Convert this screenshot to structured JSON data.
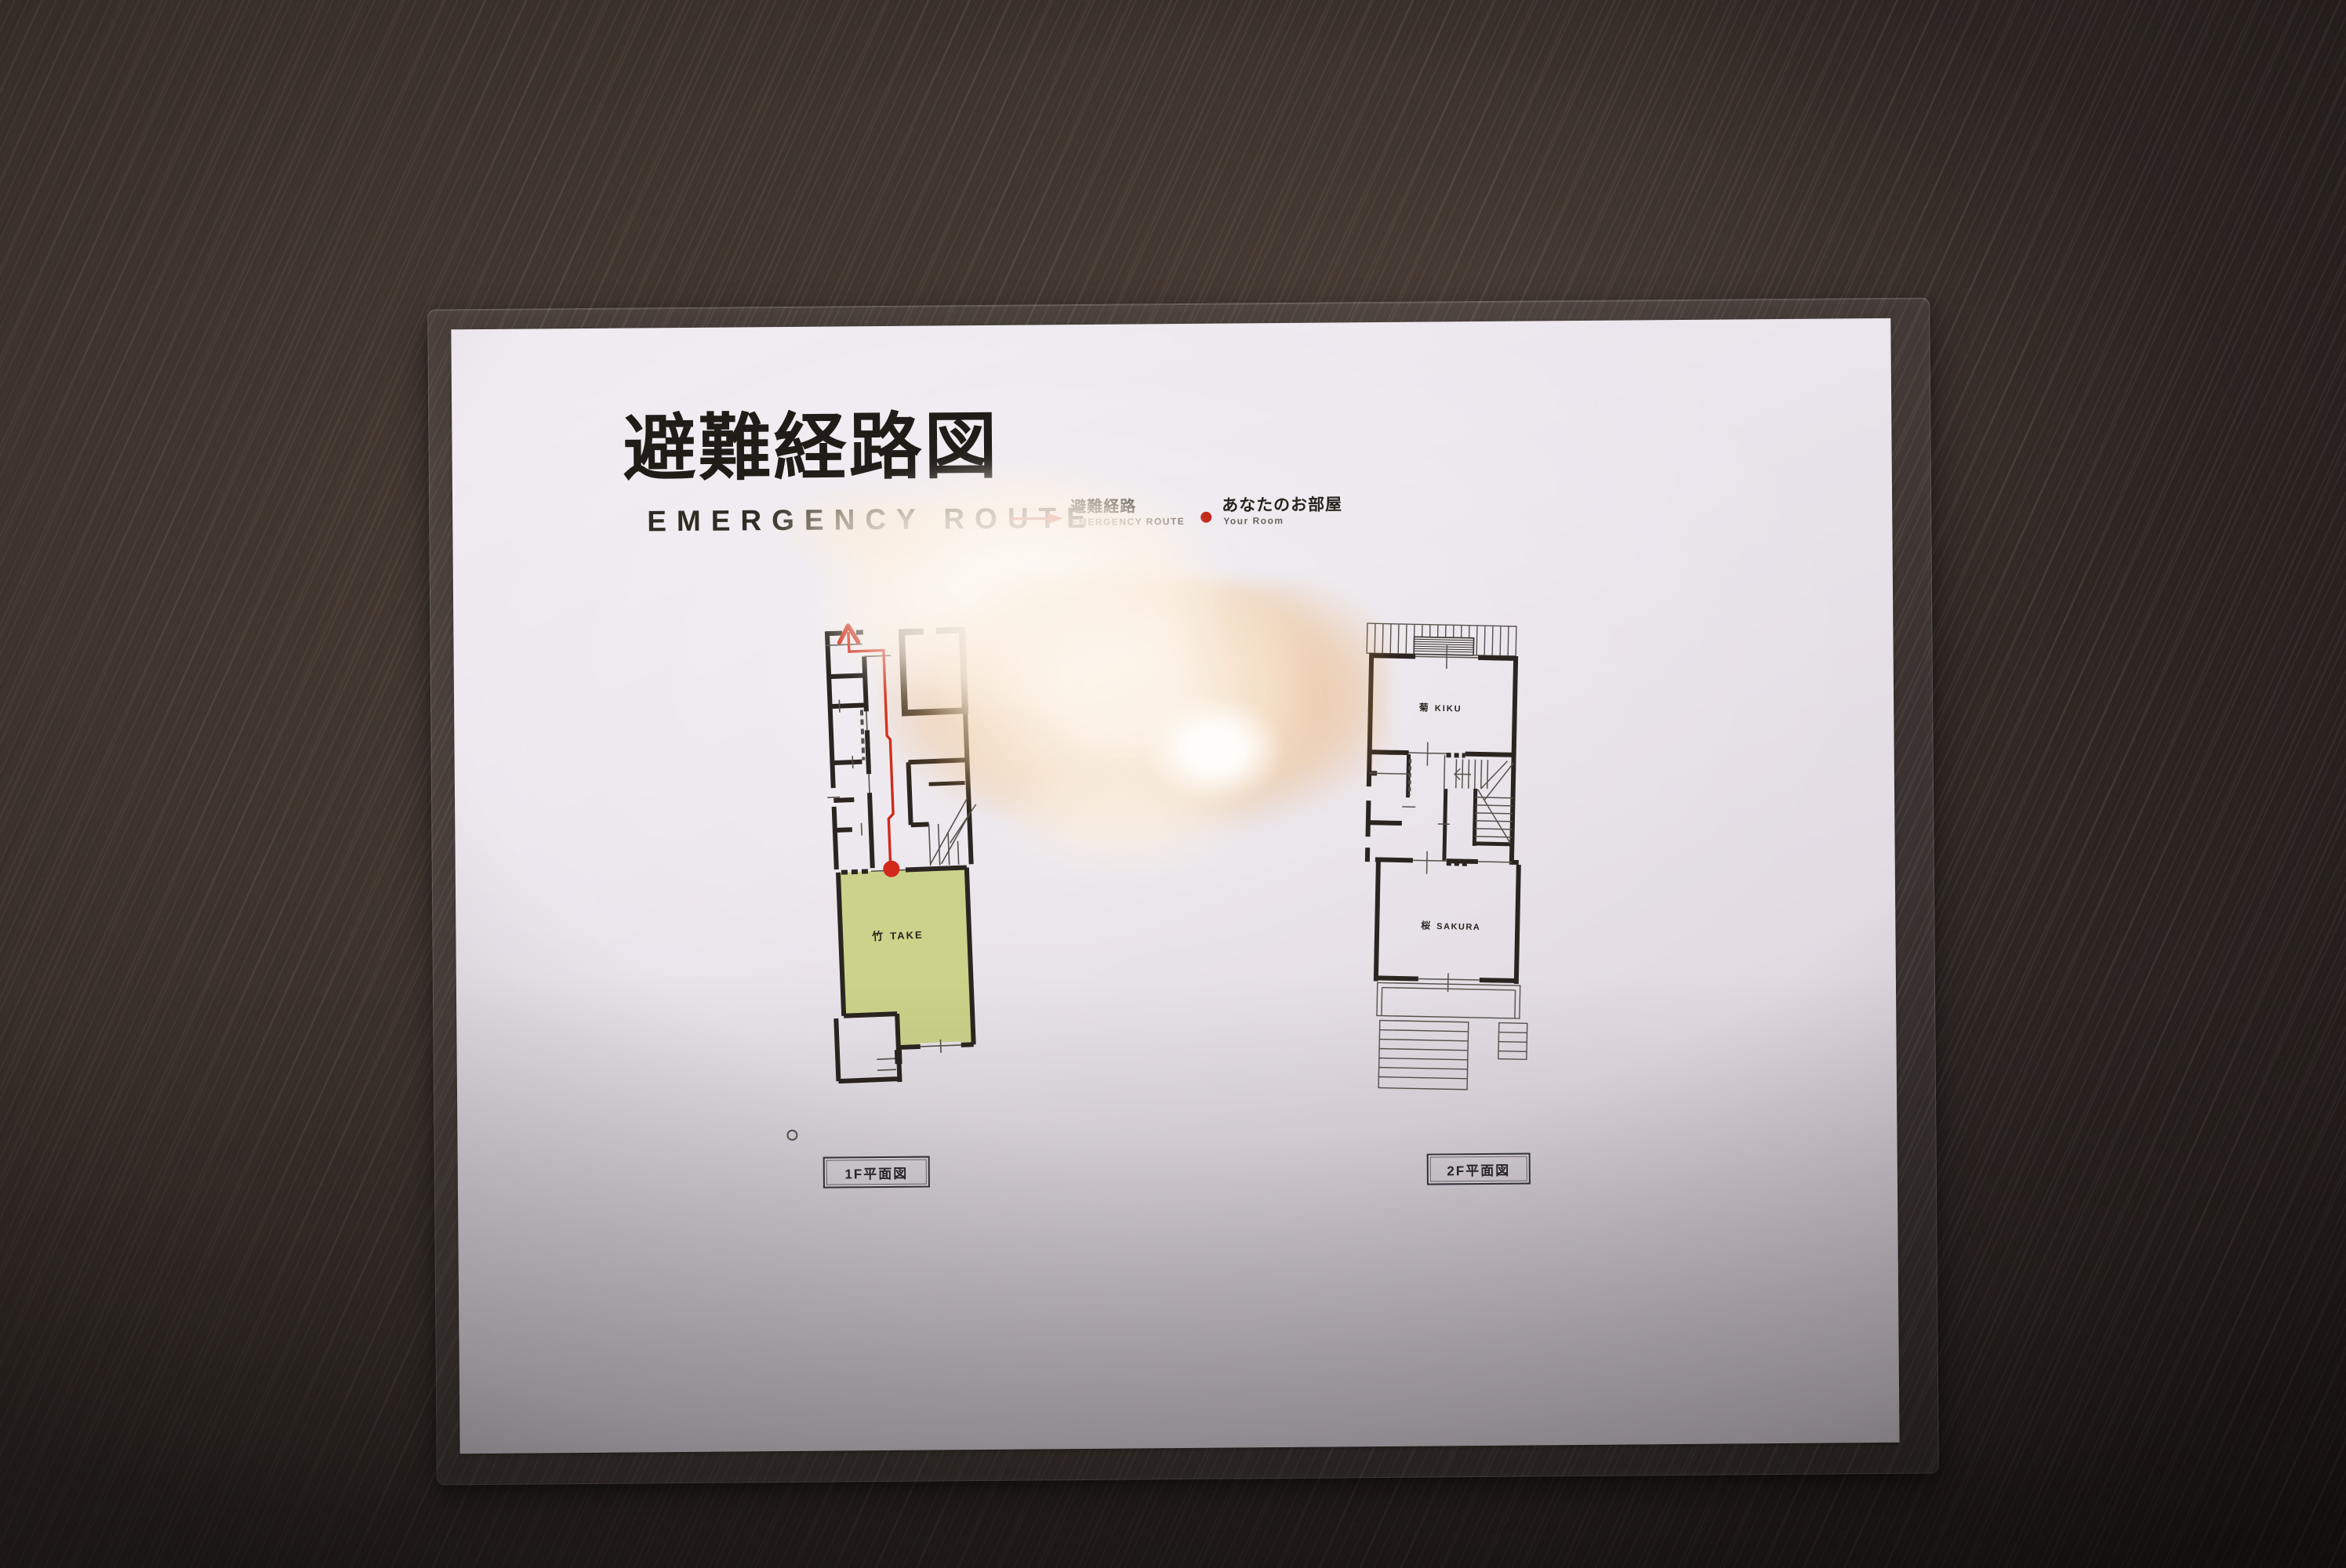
{
  "sign": {
    "title": {
      "jp": "避難経路図",
      "en": "EMERGENCY ROUTE"
    },
    "legend": {
      "route": {
        "icon": "red-arrow",
        "jp": "避難経路",
        "en": "EMERGENCY ROUTE"
      },
      "room": {
        "icon": "red-dot",
        "jp": "あなたのお部屋",
        "en": "Your Room"
      }
    },
    "floor1": {
      "caption": "1F平面図",
      "highlighted_room": {
        "jp": "竹",
        "en": "TAKE"
      },
      "route_shown": true
    },
    "floor2": {
      "caption": "2F平面図",
      "room_top": {
        "jp": "菊",
        "en": "KIKU"
      },
      "room_bottom": {
        "jp": "桜",
        "en": "SAKURA"
      }
    },
    "colors": {
      "route_red": "#cf2a1c",
      "room_dot_red": "#c32417",
      "highlight_room_green": "#ccd289",
      "wall_black": "#2b2420"
    }
  }
}
